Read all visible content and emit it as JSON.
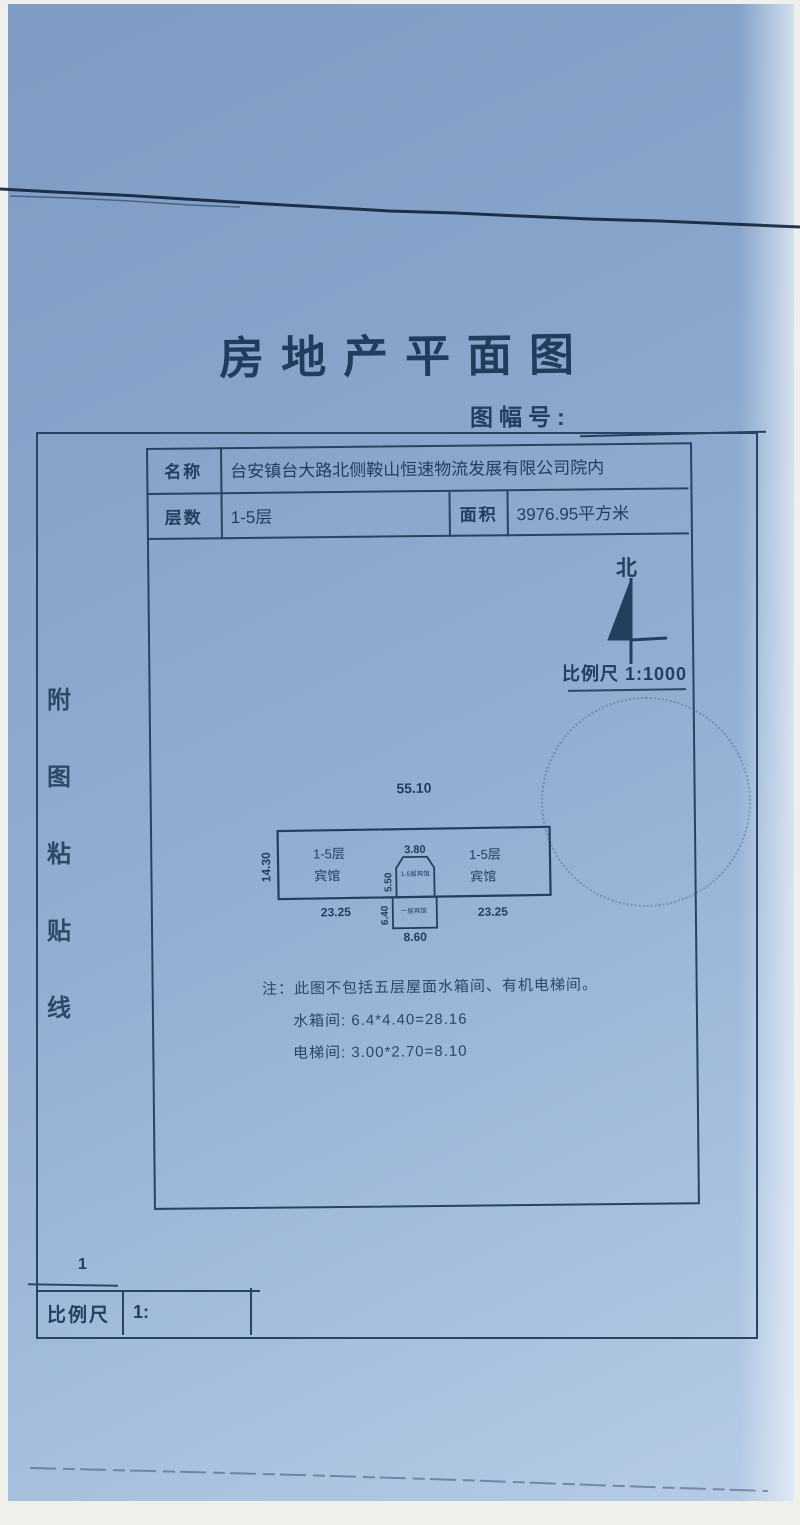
{
  "colors": {
    "ink": "#1e3a5f",
    "paper_top": "#7e9bc3",
    "paper_bottom": "#b6cce5"
  },
  "header": {
    "title": "房地产平面图",
    "sheet_no_label": "图幅号:"
  },
  "info_table": {
    "name_label": "名称",
    "name_value": "台安镇台大路北侧鞍山恒速物流发展有限公司院内",
    "floors_label": "层数",
    "floors_value": "1-5层",
    "area_label": "面积",
    "area_value": "3976.95平方米"
  },
  "compass": {
    "north_label": "北",
    "scale_text": "比例尺 1:1000"
  },
  "side_strip": {
    "chars": [
      "附",
      "图",
      "粘",
      "贴",
      "线"
    ]
  },
  "plan": {
    "dim_top": "55.10",
    "dim_left": "14.30",
    "dim_mid_top": "3.80",
    "dim_mid_upper": "5.50",
    "dim_mid_lower": "6.40",
    "dim_bottom_mid": "8.60",
    "dim_bottom_left": "23.25",
    "dim_bottom_right": "23.25",
    "left_wing_line1": "1-5层",
    "left_wing_line2": "宾馆",
    "right_wing_line1": "1-5层",
    "right_wing_line2": "宾馆",
    "center_upper_label": "1-5层宾馆",
    "center_lower_label": "一层宾馆"
  },
  "notes": {
    "line1": "注：此图不包括五层屋面水箱间、有机电梯间。",
    "line2": "水箱间: 6.4*4.40=28.16",
    "line3": "电梯间: 3.00*2.70=8.10"
  },
  "scale_bar": {
    "tick_number": "1",
    "label": "比例尺",
    "ratio_prefix": "1:"
  }
}
